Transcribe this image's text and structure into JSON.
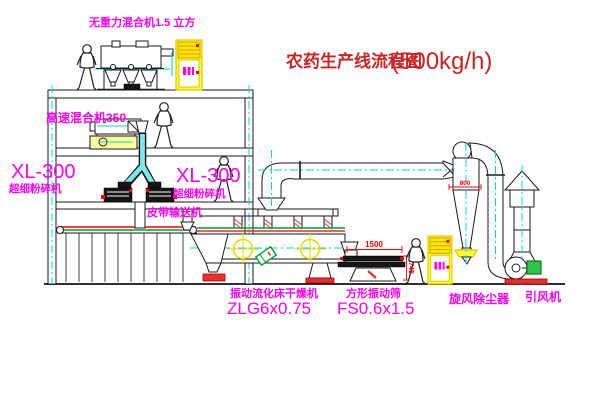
{
  "title": {
    "text": "农药生产线流程图",
    "capacity": "(500kg/h)"
  },
  "labels": {
    "top_mixer": "无重力混合机1.5 立方",
    "high_speed_mixer": "高速混合机350",
    "mill_left_model": "XL-300",
    "mill_left_name": "超细粉碎机",
    "mill_right_model": "XL-300",
    "mill_right_name": "超细粉碎机",
    "belt_conveyor": "皮带输送机",
    "dryer_name": "振动流化床干燥机",
    "dryer_model": "ZLG6x0.75",
    "screen_name": "方形振动筛",
    "screen_model": "FS0.6x1.5",
    "cyclone_name": "旋风除尘器",
    "fan_name": "引风机"
  },
  "dimensions": {
    "screen_length": "1500",
    "screen_height": "745",
    "cyclone_band": "800"
  },
  "colors": {
    "label_magenta": "#ff00f0",
    "title_red": "#cc2424",
    "line_black": "#1a1a1a",
    "centerline_cyan": "#00d8d8",
    "machine_yellow": "#ffff2e",
    "accent_red": "#e63030",
    "accent_green": "#00a32e"
  }
}
